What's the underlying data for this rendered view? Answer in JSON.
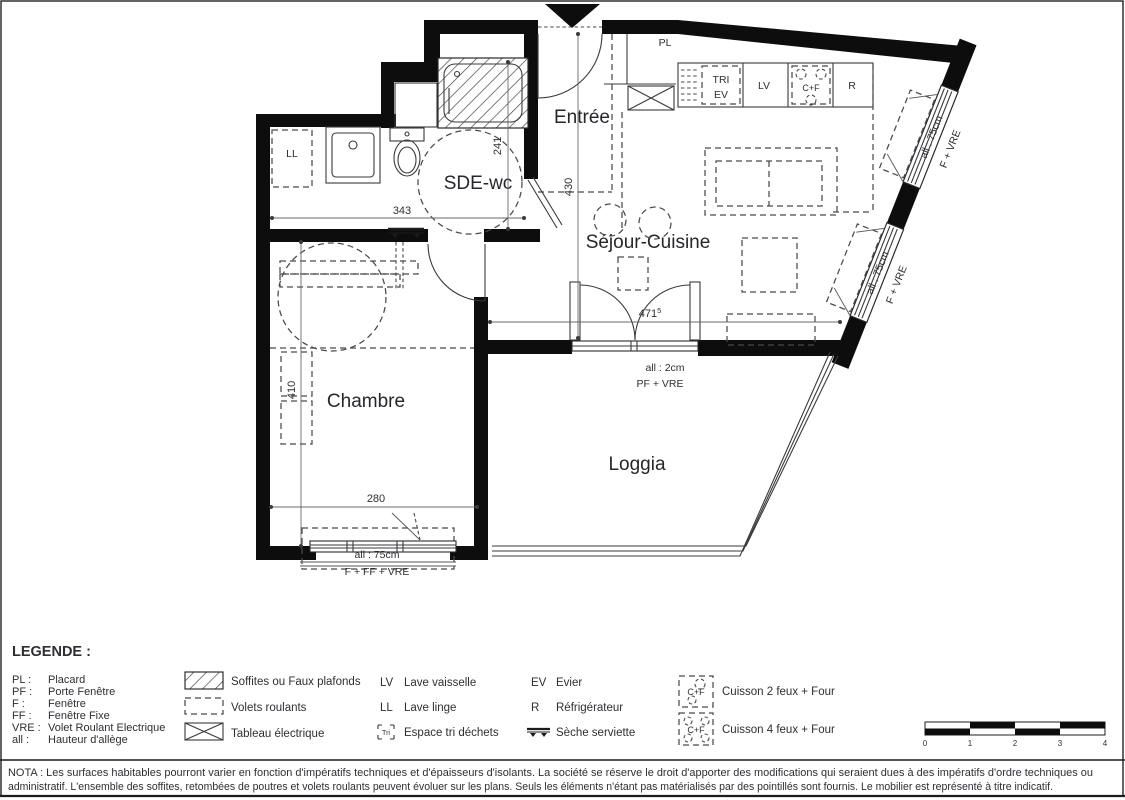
{
  "plan": {
    "rooms": {
      "entree": "Entrée",
      "sde": "SDE-wc",
      "sejour": "Séjour-Cuisine",
      "chambre": "Chambre",
      "loggia": "Loggia"
    },
    "fixtures": {
      "pl": "PL",
      "ll": "LL",
      "tri_line1": "TRI",
      "tri_line2": "EV",
      "lv": "LV",
      "cf": "C+F",
      "r": "R"
    },
    "dimensions": {
      "sde_width": "343",
      "sde_height": "241",
      "entry_height": "430",
      "sejour_width": "471",
      "sejour_width_sup": "5",
      "chambre_height": "410",
      "chambre_width": "280"
    },
    "openings": {
      "bay1": {
        "sill": "all : 75cm",
        "type": "F + VRE"
      },
      "bay2": {
        "sill": "all : 75cm",
        "type": "F + VRE"
      },
      "loggia_door": {
        "sill": "all : 2cm",
        "type": "PF + VRE"
      },
      "chambre_window": {
        "sill": "all : 75cm",
        "type": "F + FF + VRE"
      }
    }
  },
  "legend": {
    "title": "LEGENDE :",
    "abbreviations": [
      {
        "abbr": "PL :",
        "label": "Placard"
      },
      {
        "abbr": "PF :",
        "label": "Porte Fenêtre"
      },
      {
        "abbr": "F :",
        "label": "Fenêtre"
      },
      {
        "abbr": "FF :",
        "label": "Fenêtre Fixe"
      },
      {
        "abbr": "VRE :",
        "label": "Volet Roulant Electrique"
      },
      {
        "abbr": "all :",
        "label": "Hauteur d'allège"
      }
    ],
    "symbols": [
      {
        "label": "Soffites ou Faux plafonds"
      },
      {
        "label": "Volets roulants"
      },
      {
        "label": "Tableau électrique"
      }
    ],
    "appliances": [
      {
        "code": "LV",
        "label": "Lave vaisselle"
      },
      {
        "code": "LL",
        "label": "Lave linge"
      },
      {
        "code": "Tri",
        "label": "Espace tri déchets"
      },
      {
        "code": "EV",
        "label": "Evier"
      },
      {
        "code": "R",
        "label": "Réfrigérateur"
      },
      {
        "code": "",
        "label": "Sèche serviette"
      }
    ],
    "cooking": [
      {
        "icon_text": "C+F",
        "label": "Cuisson 2 feux + Four"
      },
      {
        "icon_text": "C+F",
        "label": "Cuisson 4 feux + Four"
      }
    ]
  },
  "scale_bar": {
    "ticks": [
      "0",
      "1",
      "2",
      "3",
      "4"
    ]
  },
  "nota": {
    "line1": "NOTA : Les surfaces habitables pourront varier en fonction d'impératifs techniques et d'épaisseurs d'isolants. La société se réserve le droit d'apporter des modifications qui seraient dues à des impératifs d'ordre techniques ou",
    "line2": "administratif. L'ensemble des soffites, retombées de poutres et volets roulants peuvent évoluer sur les plans. Seuls les éléments n'étant pas matérialisés par des pointillés sont fournis. Le mobilier est représenté à titre indicatif."
  },
  "colors": {
    "wall": "#0d0d0d",
    "line": "#3a3a3a",
    "text": "#2e2e36"
  }
}
